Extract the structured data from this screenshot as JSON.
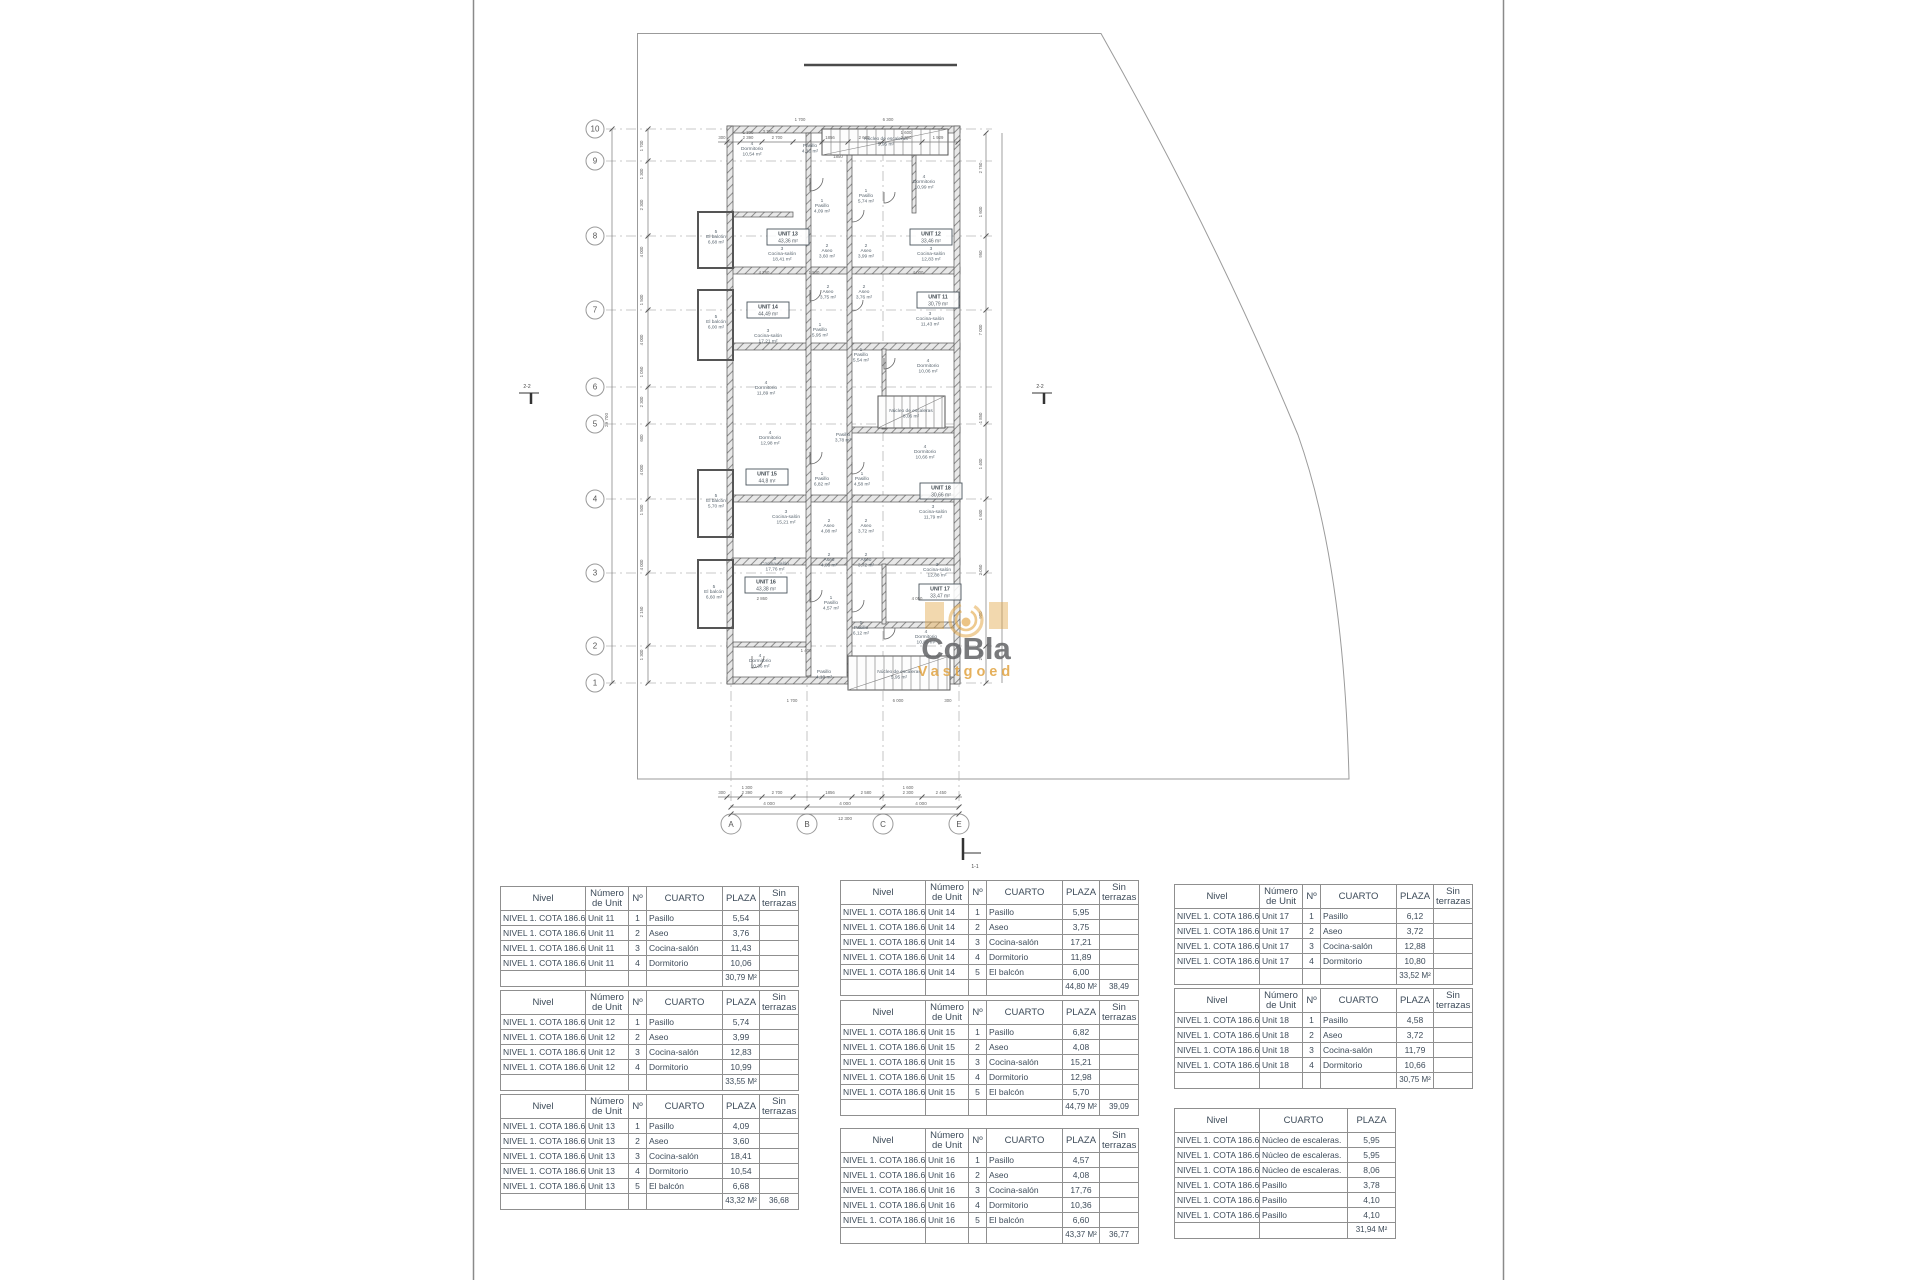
{
  "drawing": {
    "watermark": {
      "brand": "CoBla",
      "sub": "Vastgoed",
      "accent_color": "#E2A646",
      "brand_color": "#67686B"
    },
    "grid_rows": [
      "10",
      "9",
      "8",
      "7",
      "6",
      "5",
      "4",
      "3",
      "2",
      "1"
    ],
    "grid_cols": [
      "A",
      "B",
      "C",
      "E"
    ],
    "section_markers": [
      {
        "label": "2-2",
        "x": 527,
        "y": 388
      },
      {
        "label": "2-2",
        "x": 1040,
        "y": 388
      },
      {
        "label": "1-1",
        "x": 967,
        "y": 868
      }
    ],
    "unit_boxes": [
      {
        "label": "UNIT 13",
        "area": "43,36 m²",
        "x": 788,
        "y": 237
      },
      {
        "label": "UNIT 12",
        "area": "33,46 m²",
        "x": 931,
        "y": 237
      },
      {
        "label": "UNIT 14",
        "area": "44,49 m²",
        "x": 768,
        "y": 310
      },
      {
        "label": "UNIT 11",
        "area": "30,79 m²",
        "x": 938,
        "y": 300
      },
      {
        "label": "UNIT 15",
        "area": "44,8 m²",
        "x": 767,
        "y": 477
      },
      {
        "label": "UNIT 18",
        "area": "30,66 m²",
        "x": 941,
        "y": 491
      },
      {
        "label": "UNIT 16",
        "area": "43,38 m²",
        "x": 766,
        "y": 585
      },
      {
        "label": "UNIT 17",
        "area": "33,47 m²",
        "x": 940,
        "y": 592
      }
    ],
    "rooms": [
      [
        "4",
        "Dormitorio",
        "10,54 m²",
        752,
        150
      ],
      [
        "",
        "Pasillo",
        "4,10 m²",
        810,
        147
      ],
      [
        "",
        "Núcleo de escaleras",
        "5,95 m²",
        886,
        140
      ],
      [
        "4",
        "Dormitorio",
        "10,99 m²",
        924,
        183
      ],
      [
        "1",
        "Pasillo",
        "4,09 m²",
        822,
        207
      ],
      [
        "1",
        "Pasillo",
        "5,74 m²",
        866,
        197
      ],
      [
        "2",
        "Aseo",
        "3,60 m²",
        827,
        252
      ],
      [
        "2",
        "Aseo",
        "3,99 m²",
        866,
        252
      ],
      [
        "3",
        "Cocina-salón",
        "18,41 m²",
        782,
        255
      ],
      [
        "3",
        "Cocina-salón",
        "12,83 m²",
        931,
        255
      ],
      [
        "5",
        "El balcón",
        "6,68 m²",
        716,
        238
      ],
      [
        "2",
        "Aseo",
        "3,75 m²",
        828,
        293
      ],
      [
        "2",
        "Aseo",
        "3,76 m²",
        864,
        293
      ],
      [
        "3",
        "Cocina-salón",
        "11,43 m²",
        930,
        320
      ],
      [
        "5",
        "El balcón",
        "6,00 m²",
        716,
        323
      ],
      [
        "3",
        "Cocina-salón",
        "17,21 m²",
        768,
        337
      ],
      [
        "1",
        "Pasillo",
        "5,95 m²",
        820,
        331
      ],
      [
        "1",
        "Pasillo",
        "5,54 m²",
        861,
        356
      ],
      [
        "4",
        "Dormitorio",
        "10,06 m²",
        928,
        367
      ],
      [
        "4",
        "Dormitorio",
        "11,89 m²",
        766,
        389
      ],
      [
        "",
        "Pasillo",
        "3,78 m²",
        843,
        436
      ],
      [
        "",
        "Núcleo de escaleras",
        "8,06 m²",
        911,
        412
      ],
      [
        "4",
        "Dormitorio",
        "12,98 m²",
        770,
        439
      ],
      [
        "4",
        "Dormitorio",
        "10,66 m²",
        925,
        453
      ],
      [
        "1",
        "Pasillo",
        "6,82 m²",
        822,
        480
      ],
      [
        "1",
        "Pasillo",
        "4,58 m²",
        862,
        480
      ],
      [
        "5",
        "El balcón",
        "5,70 m²",
        716,
        502
      ],
      [
        "3",
        "Cocina-salón",
        "15,21 m²",
        786,
        518
      ],
      [
        "2",
        "Aseo",
        "4,08 m²",
        829,
        527
      ],
      [
        "2",
        "Aseo",
        "3,72 m²",
        866,
        527
      ],
      [
        "3",
        "Cocina-salón",
        "11,79 m²",
        933,
        513
      ],
      [
        "2",
        "Aseo",
        "4,08 m²",
        829,
        561
      ],
      [
        "2",
        "Aseo",
        "3,72 m²",
        866,
        561
      ],
      [
        "3",
        "Cocina-salón",
        "17,76 m²",
        775,
        565
      ],
      [
        "3",
        "Cocina-salón",
        "12,88 m²",
        937,
        571
      ],
      [
        "5",
        "El balcón",
        "6,60 m²",
        714,
        593
      ],
      [
        "1",
        "Pasillo",
        "4,57 m²",
        831,
        604
      ],
      [
        "1",
        "Pasillo",
        "6,12 m²",
        861,
        629
      ],
      [
        "4",
        "Dormitorio",
        "10,80 m²",
        926,
        638
      ],
      [
        "4",
        "Dormitorio",
        "10,36 m²",
        760,
        662
      ],
      [
        "",
        "Pasillo",
        "4,10 m²",
        824,
        673
      ],
      [
        "",
        "Núcleo de escaleras",
        "5,95 m²",
        899,
        673
      ]
    ],
    "dims_top": [
      [
        "300",
        722
      ],
      [
        "2 390",
        748
      ],
      [
        "2 700",
        777
      ],
      [
        "1856",
        830
      ],
      [
        "2 630",
        864
      ],
      [
        "2 300",
        906
      ],
      [
        "1 929",
        938
      ]
    ],
    "dims_top_upper": [
      [
        "1 300",
        748
      ],
      [
        "1 600",
        906
      ]
    ],
    "dims_bottom1": [
      [
        "300",
        722
      ],
      [
        "2 390",
        747
      ],
      [
        "2 700",
        777
      ],
      [
        "1856",
        830
      ],
      [
        "2 580",
        866
      ],
      [
        "2 300",
        908
      ],
      [
        "2 450",
        941
      ]
    ],
    "dims_bottom1_upper": [
      [
        "1 300",
        747
      ],
      [
        "1 600",
        908
      ]
    ],
    "dims_bottom2": [
      [
        "4 000",
        769
      ],
      [
        "4 000",
        845
      ],
      [
        "4 000",
        921
      ]
    ],
    "dim_total_bottom": "12 300",
    "dims_left": [
      [
        "1 700",
        146
      ],
      [
        "1 300",
        174
      ],
      [
        "2 300",
        205
      ],
      [
        "4 000",
        252
      ],
      [
        "1 500",
        300
      ],
      [
        "4 000",
        340
      ],
      [
        "1 050",
        372
      ],
      [
        "2 300",
        402
      ],
      [
        "600",
        438
      ],
      [
        "4 000",
        470
      ],
      [
        "1 500",
        510
      ],
      [
        "4 000",
        565
      ],
      [
        "2 150",
        612
      ],
      [
        "1 300",
        655
      ]
    ],
    "dim_total_left": "29 700",
    "dims_right": [
      [
        "2 750",
        168
      ],
      [
        "1 600",
        212
      ],
      [
        "950",
        254
      ],
      [
        "7 000",
        330
      ],
      [
        "1 850",
        418
      ],
      [
        "1 400",
        464
      ],
      [
        "1 600",
        515
      ],
      [
        "2 050",
        570
      ],
      [
        "900",
        615
      ],
      [
        "2 760",
        655
      ]
    ],
    "dims_misc": [
      [
        "1 700",
        800,
        121
      ],
      [
        "6 300",
        888,
        121
      ],
      [
        "3 760",
        768,
        133
      ],
      [
        "1850",
        838,
        158
      ],
      [
        "4 250",
        764,
        274
      ],
      [
        "1 500",
        814,
        274
      ],
      [
        "4 000",
        918,
        274
      ],
      [
        "4 050",
        917,
        600
      ],
      [
        "2 860",
        762,
        600
      ],
      [
        "1 400",
        806,
        652
      ],
      [
        "1 700",
        792,
        702
      ],
      [
        "6 000",
        898,
        702
      ],
      [
        "300",
        948,
        702
      ]
    ]
  },
  "tables": {
    "headers": {
      "nivel": "Nivel",
      "numero": "Número de Unit",
      "no": "Nº",
      "cuarto": "CUARTO",
      "plaza": "PLAZA",
      "sin": "Sin terrazas"
    },
    "nivel_value": "NIVEL 1. COTA 186.60",
    "unit_tables": [
      {
        "id": "u11",
        "unit": "Unit 11",
        "rows": [
          [
            "1",
            "Pasillo",
            "5,54"
          ],
          [
            "2",
            "Aseo",
            "3,76"
          ],
          [
            "3",
            "Cocina-salón",
            "11,43"
          ],
          [
            "4",
            "Dormitorio",
            "10,06"
          ]
        ],
        "total": "30,79 M²",
        "sin_total": ""
      },
      {
        "id": "u12",
        "unit": "Unit 12",
        "rows": [
          [
            "1",
            "Pasillo",
            "5,74"
          ],
          [
            "2",
            "Aseo",
            "3,99"
          ],
          [
            "3",
            "Cocina-salón",
            "12,83"
          ],
          [
            "4",
            "Dormitorio",
            "10,99"
          ]
        ],
        "total": "33,55 M²",
        "sin_total": ""
      },
      {
        "id": "u13",
        "unit": "Unit 13",
        "rows": [
          [
            "1",
            "Pasillo",
            "4,09"
          ],
          [
            "2",
            "Aseo",
            "3,60"
          ],
          [
            "3",
            "Cocina-salón",
            "18,41"
          ],
          [
            "4",
            "Dormitorio",
            "10,54"
          ],
          [
            "5",
            "El balcón",
            "6,68"
          ]
        ],
        "total": "43,32 M²",
        "sin_total": "36,68"
      },
      {
        "id": "u14",
        "unit": "Unit 14",
        "rows": [
          [
            "1",
            "Pasillo",
            "5,95"
          ],
          [
            "2",
            "Aseo",
            "3,75"
          ],
          [
            "3",
            "Cocina-salón",
            "17,21"
          ],
          [
            "4",
            "Dormitorio",
            "11,89"
          ],
          [
            "5",
            "El balcón",
            "6,00"
          ]
        ],
        "total": "44,80 M²",
        "sin_total": "38,49"
      },
      {
        "id": "u15",
        "unit": "Unit 15",
        "rows": [
          [
            "1",
            "Pasillo",
            "6,82"
          ],
          [
            "2",
            "Aseo",
            "4,08"
          ],
          [
            "3",
            "Cocina-salón",
            "15,21"
          ],
          [
            "4",
            "Dormitorio",
            "12,98"
          ],
          [
            "5",
            "El balcón",
            "5,70"
          ]
        ],
        "total": "44,79 M²",
        "sin_total": "39,09"
      },
      {
        "id": "u16",
        "unit": "Unit 16",
        "rows": [
          [
            "1",
            "Pasillo",
            "4,57"
          ],
          [
            "2",
            "Aseo",
            "4,08"
          ],
          [
            "3",
            "Cocina-salón",
            "17,76"
          ],
          [
            "4",
            "Dormitorio",
            "10,36"
          ],
          [
            "5",
            "El balcón",
            "6,60"
          ]
        ],
        "total": "43,37 M²",
        "sin_total": "36,77"
      },
      {
        "id": "u17",
        "unit": "Unit 17",
        "rows": [
          [
            "1",
            "Pasillo",
            "6,12"
          ],
          [
            "2",
            "Aseo",
            "3,72"
          ],
          [
            "3",
            "Cocina-salón",
            "12,88"
          ],
          [
            "4",
            "Dormitorio",
            "10,80"
          ]
        ],
        "total": "33,52 M²",
        "sin_total": ""
      },
      {
        "id": "u18",
        "unit": "Unit 18",
        "rows": [
          [
            "1",
            "Pasillo",
            "4,58"
          ],
          [
            "2",
            "Aseo",
            "3,72"
          ],
          [
            "3",
            "Cocina-salón",
            "11,79"
          ],
          [
            "4",
            "Dormitorio",
            "10,66"
          ]
        ],
        "total": "30,75 M²",
        "sin_total": ""
      }
    ],
    "common_table": {
      "rows": [
        [
          "Núcleo de escaleras.",
          "5,95"
        ],
        [
          "Núcleo de escaleras.",
          "5,95"
        ],
        [
          "Núcleo de escaleras.",
          "8,06"
        ],
        [
          "Pasillo",
          "3,78"
        ],
        [
          "Pasillo",
          "4,10"
        ],
        [
          "Pasillo",
          "4,10"
        ]
      ],
      "total": "31,94 M²"
    }
  }
}
